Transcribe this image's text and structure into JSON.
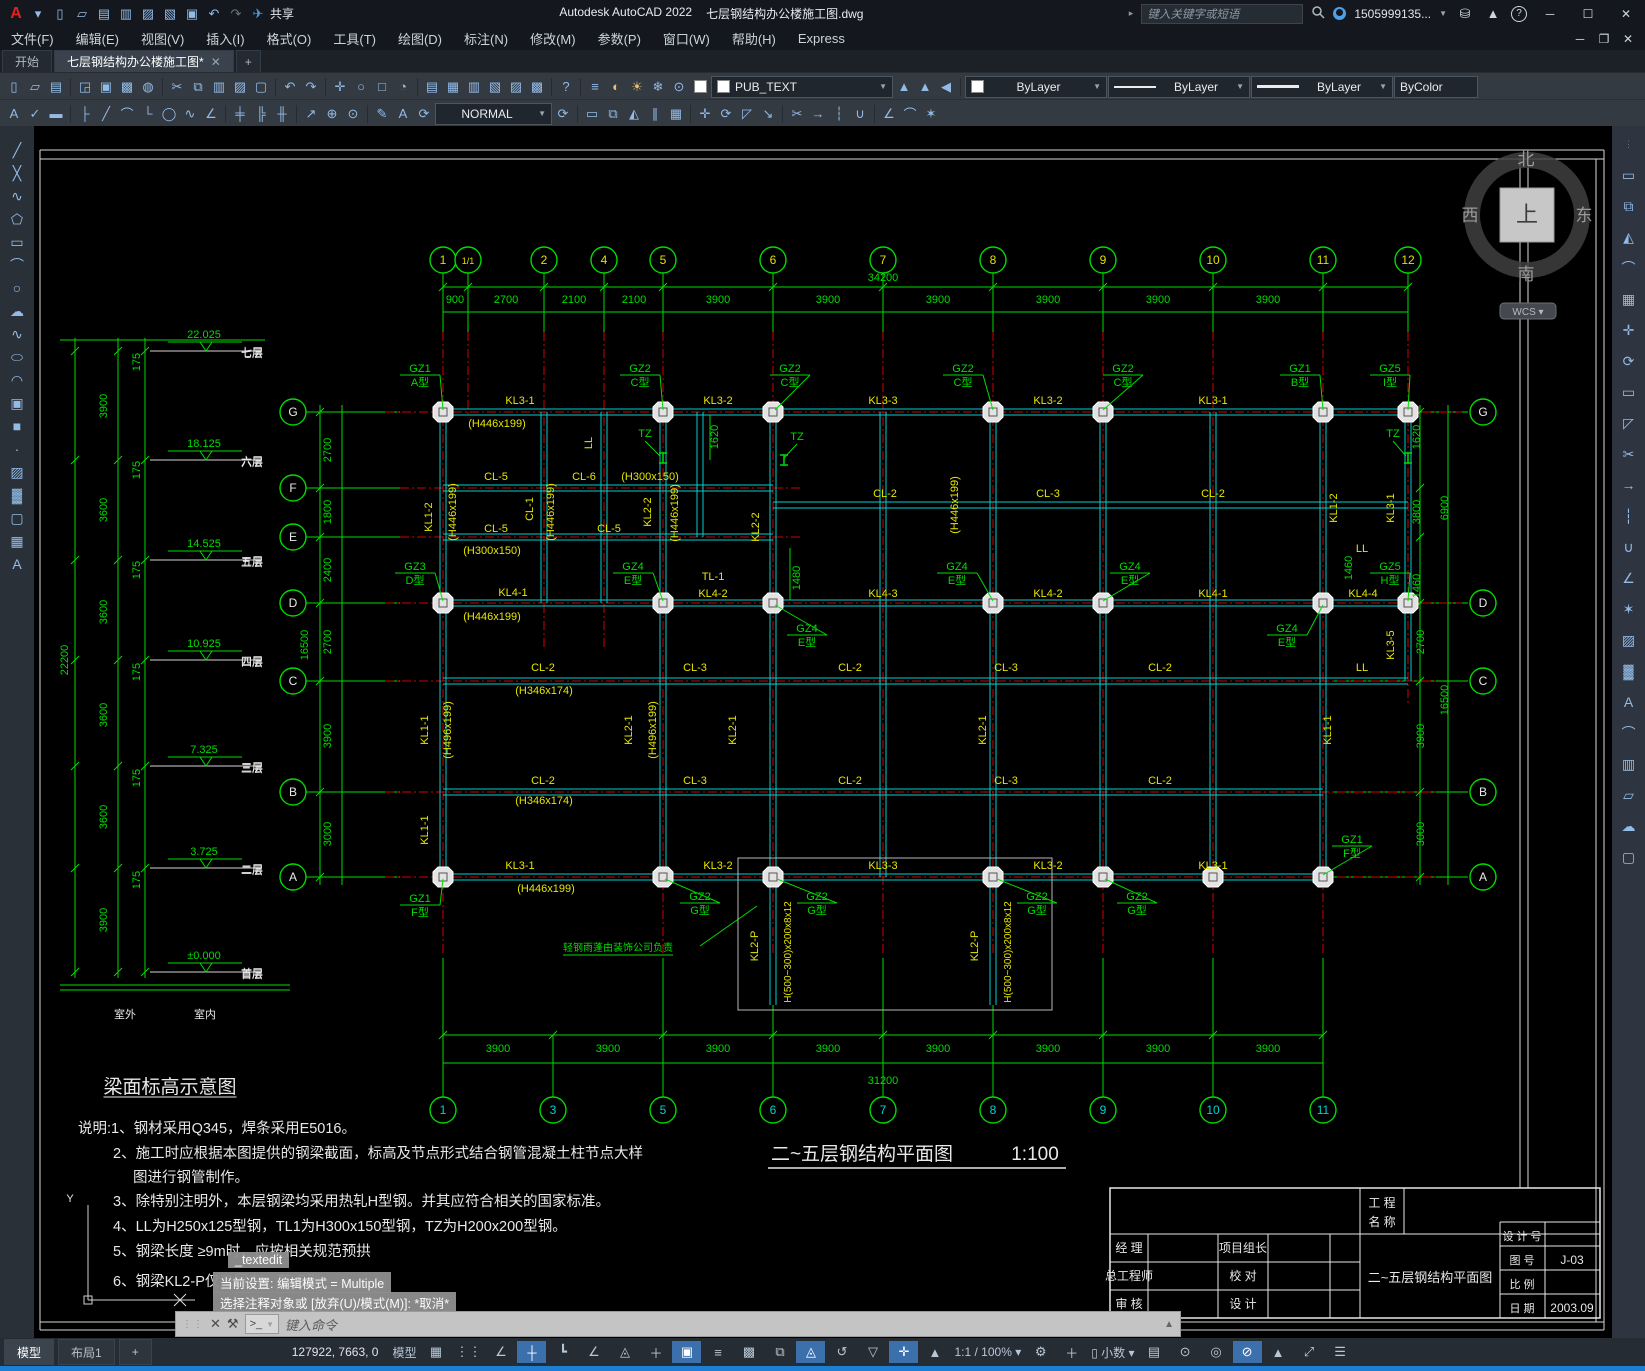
{
  "window": {
    "app_title": "Autodesk AutoCAD 2022",
    "doc_title": "七层钢结构办公楼施工图.dwg",
    "share_label": "共享",
    "search_placeholder": "键入关键字或短语",
    "username": "1505999135...",
    "win_min": "─",
    "win_max": "☐",
    "win_close": "✕",
    "doc_min": "─",
    "doc_restore": "❐",
    "doc_close": "✕"
  },
  "menus": [
    "文件(F)",
    "编辑(E)",
    "视图(V)",
    "插入(I)",
    "格式(O)",
    "工具(T)",
    "绘图(D)",
    "标注(N)",
    "修改(M)",
    "参数(P)",
    "窗口(W)",
    "帮助(H)",
    "Express"
  ],
  "tabs": {
    "start": "开始",
    "doc": "七层钢结构办公楼施工图*",
    "close": "✕",
    "plus": "+"
  },
  "qat_icons": [
    "app-logo",
    "caret-down",
    "new-file",
    "open-folder",
    "save",
    "save-as",
    "export",
    "sheet",
    "print",
    "undo",
    "redo",
    "share-plane"
  ],
  "toolbar1_icons": [
    "new-file",
    "open-folder",
    "save",
    "plot-preview",
    "plot",
    "page-setup",
    "publish-web",
    "cut",
    "copy",
    "paste",
    "match-properties",
    "block-editor",
    "undo",
    "redo",
    "pan",
    "zoom-realtime",
    "zoom-window",
    "zoom-previous",
    "properties",
    "design-center",
    "tool-palettes",
    "sheet-set",
    "markup",
    "quick-calc",
    "help"
  ],
  "layer_icons": [
    "layer-properties",
    "bulb",
    "sun",
    "freeze",
    "lock",
    "color-swatch"
  ],
  "layer_tool_icons": [
    "make-current",
    "match-layer",
    "layer-previous"
  ],
  "toolbar2_left_icons": [
    "text-edit",
    "spell-check",
    "edit-eraser"
  ],
  "dim_icons": [
    "dim-linear",
    "dim-aligned",
    "dim-arc",
    "dim-ordinate",
    "dim-radius",
    "dim-jogged",
    "dim-angular",
    "quick-dim",
    "dim-baseline",
    "dim-continue",
    "leader",
    "tolerance",
    "center-mark",
    "dim-edit",
    "dim-text-edit",
    "dim-update"
  ],
  "modify_icons": [
    "erase",
    "copy",
    "mirror",
    "offset",
    "array",
    "move",
    "rotate",
    "scale",
    "stretch",
    "trim",
    "extend",
    "break",
    "join",
    "chamfer",
    "fillet",
    "explode"
  ],
  "draw_icons_left": [
    "line",
    "xline",
    "polyline",
    "polygon",
    "rectangle",
    "arc",
    "circle",
    "revcloud",
    "spline",
    "ellipse",
    "ellipse-arc",
    "insert-block",
    "make-block",
    "point",
    "hatch",
    "gradient",
    "region",
    "table",
    "mtext"
  ],
  "right_icons": [
    "grip",
    "erase",
    "copy",
    "mirror",
    "fillet",
    "array",
    "move",
    "rotate",
    "rectangle",
    "scale",
    "trim",
    "extend",
    "break",
    "join",
    "chamfer",
    "explode",
    "hatch",
    "gradient",
    "text",
    "measure",
    "paste",
    "wipeout",
    "revcloud",
    "boundary"
  ],
  "combos": {
    "layer": "PUB_TEXT",
    "dimstyle": "NORMAL",
    "color": "ByLayer",
    "linetype": "ByLayer",
    "lineweight": "ByLayer",
    "plotstyle": "ByColor"
  },
  "viewcube": {
    "north": "北",
    "south": "南",
    "east": "东",
    "west": "西",
    "top": "上",
    "wcs": "WCS"
  },
  "statusbar": {
    "tabs": [
      "模型",
      "布局1",
      "+"
    ],
    "coords": "127922, 7663, 0",
    "model_btn": "模型",
    "scale": "1:1 / 100%",
    "units": "小数",
    "icons_a": [
      "grid",
      "snap",
      "infer",
      "dynamic-input",
      "ortho",
      "polar",
      "iso",
      "otrack",
      "osnap"
    ],
    "icons_b": [
      "lineweight",
      "transparency",
      "cycling",
      "3dosnap",
      "ducs",
      "filter",
      "gizmo",
      "annotation"
    ],
    "icons_c": [
      "quick-properties",
      "lock-ui",
      "isolate",
      "hardware",
      "performance",
      "clean-screen",
      "customize"
    ]
  },
  "overlays": {
    "textedit": "_textedit",
    "current_setting": "当前设置: 编辑模式 = Multiple",
    "prompt": "选择注释对象或 [放弃(U)/模式(M)]: *取消*",
    "cmd_placeholder": "键入命令"
  },
  "titleblock": {
    "project_l1": "工  程",
    "project_l2": "名  称",
    "manager": "经  理",
    "chief": "总工程师",
    "review": "审  核",
    "leader": "项目组长",
    "proof": "校  对",
    "design": "设  计",
    "drawing_name": "二~五层钢结构平面图",
    "design_no": "设 计 号",
    "sheet_no": "图  号",
    "sheet_no_value": "J-03",
    "scale_label": "比  例",
    "date_label": "日  期",
    "date_value": "2003.09"
  },
  "drawing": {
    "plan_title": "二~五层钢结构平面图",
    "plan_scale": "1:100",
    "top_bubbles": [
      [
        "1",
        443
      ],
      [
        "1/1",
        468
      ],
      [
        "2",
        544
      ],
      [
        "4",
        604
      ],
      [
        "5",
        663
      ],
      [
        "6",
        773
      ],
      [
        "7",
        883
      ],
      [
        "8",
        993
      ],
      [
        "9",
        1103
      ],
      [
        "10",
        1213
      ],
      [
        "11",
        1323
      ],
      [
        "12",
        1408
      ]
    ],
    "bottom_bubbles": [
      [
        "1",
        443
      ],
      [
        "3",
        553
      ],
      [
        "5",
        663
      ],
      [
        "6",
        773
      ],
      [
        "7",
        883
      ],
      [
        "8",
        993
      ],
      [
        "9",
        1103
      ],
      [
        "10",
        1213
      ],
      [
        "11",
        1323
      ]
    ],
    "row_bubbles_left": [
      [
        "G",
        412
      ],
      [
        "F",
        488
      ],
      [
        "E",
        537
      ],
      [
        "D",
        603
      ],
      [
        "C",
        681
      ],
      [
        "B",
        792
      ],
      [
        "A",
        877
      ]
    ],
    "row_bubbles_right": [
      [
        "G",
        412
      ],
      [
        "D",
        603
      ],
      [
        "C",
        681
      ],
      [
        "B",
        792
      ],
      [
        "A",
        877
      ]
    ],
    "levels": [
      [
        "22.025",
        "七层",
        351
      ],
      [
        "18.125",
        "六层",
        460
      ],
      [
        "14.525",
        "五层",
        560
      ],
      [
        "10.925",
        "四层",
        660
      ],
      [
        "7.325",
        "三层",
        766
      ],
      [
        "3.725",
        "二层",
        868
      ],
      [
        "±0.000",
        "首层",
        972
      ]
    ],
    "gz_tags": [
      [
        "GZ1",
        "A型",
        420,
        372,
        443,
        410
      ],
      [
        "GZ2",
        "C型",
        640,
        372,
        663,
        410
      ],
      [
        "GZ2",
        "C型",
        790,
        372,
        775,
        410
      ],
      [
        "GZ2",
        "C型",
        963,
        372,
        993,
        410
      ],
      [
        "GZ2",
        "C型",
        1123,
        372,
        1103,
        410
      ],
      [
        "GZ1",
        "B型",
        1300,
        372,
        1323,
        410
      ],
      [
        "GZ5",
        "I型",
        1390,
        372,
        1408,
        410
      ],
      [
        "GZ3",
        "D型",
        415,
        570,
        443,
        601
      ],
      [
        "GZ4",
        "E型",
        633,
        570,
        663,
        601
      ],
      [
        "GZ4",
        "E型",
        807,
        632,
        775,
        605
      ],
      [
        "GZ4",
        "E型",
        957,
        570,
        993,
        601
      ],
      [
        "GZ4",
        "E型",
        1130,
        570,
        1103,
        601
      ],
      [
        "GZ4",
        "E型",
        1287,
        632,
        1323,
        605
      ],
      [
        "GZ5",
        "H型",
        1390,
        570,
        1408,
        601
      ],
      [
        "GZ1",
        "F型",
        420,
        902,
        443,
        879
      ],
      [
        "GZ2",
        "G型",
        700,
        900,
        665,
        879
      ],
      [
        "GZ2",
        "G型",
        817,
        900,
        777,
        879
      ],
      [
        "GZ2",
        "G型",
        1037,
        900,
        997,
        879
      ],
      [
        "GZ2",
        "G型",
        1137,
        900,
        1105,
        879
      ],
      [
        "GZ1",
        "F型",
        1352,
        843,
        1323,
        875
      ]
    ],
    "texts": [
      [
        "KL3-1",
        520,
        404,
        "y"
      ],
      [
        "KL3-2",
        718,
        404,
        "y"
      ],
      [
        "KL3-3",
        883,
        404,
        "y"
      ],
      [
        "KL3-2",
        1048,
        404,
        "y"
      ],
      [
        "KL3-1",
        1213,
        404,
        "y"
      ],
      [
        "(H446x199)",
        497,
        427,
        "y"
      ],
      [
        "CL-5",
        496,
        480,
        "y"
      ],
      [
        "CL-6",
        584,
        480,
        "y"
      ],
      [
        "(H300x150)",
        650,
        480,
        "y"
      ],
      [
        "CL-5",
        496,
        532,
        "y"
      ],
      [
        "CL-5",
        609,
        532,
        "y"
      ],
      [
        "(H300x150)",
        492,
        554,
        "y"
      ],
      [
        "CL-1",
        533,
        509,
        "yr"
      ],
      [
        "(H446x199)",
        456,
        512,
        "yr"
      ],
      [
        "(H446x199)",
        554,
        512,
        "yr"
      ],
      [
        "KL1-2",
        432,
        517,
        "yr"
      ],
      [
        "KL2-2",
        651,
        512,
        "yr"
      ],
      [
        "(H446x199)",
        678,
        513,
        "yr"
      ],
      [
        "KL2-2",
        759,
        527,
        "yr"
      ],
      [
        "(H446x199)",
        958,
        505,
        "yr"
      ],
      [
        "LL",
        592,
        443,
        "yr"
      ],
      [
        "LL",
        1362,
        671,
        "y"
      ],
      [
        "LL",
        1362,
        552,
        "y"
      ],
      [
        "TZ",
        645,
        437,
        "g"
      ],
      [
        "TZ",
        797,
        440,
        "g"
      ],
      [
        "TZ",
        1393,
        437,
        "g"
      ],
      [
        "CL-2",
        885,
        497,
        "y"
      ],
      [
        "CL-3",
        1048,
        497,
        "y"
      ],
      [
        "CL-2",
        1213,
        497,
        "y"
      ],
      [
        "KL4-1",
        513,
        596,
        "y"
      ],
      [
        "TL-1",
        713,
        580,
        "y"
      ],
      [
        "KL4-2",
        713,
        597,
        "y"
      ],
      [
        "KL4-3",
        883,
        597,
        "y"
      ],
      [
        "KL4-2",
        1048,
        597,
        "y"
      ],
      [
        "KL4-1",
        1213,
        597,
        "y"
      ],
      [
        "KL4-4",
        1363,
        597,
        "y"
      ],
      [
        "(H446x199)",
        492,
        620,
        "y"
      ],
      [
        "CL-2",
        543,
        671,
        "y"
      ],
      [
        "CL-3",
        695,
        671,
        "y"
      ],
      [
        "CL-2",
        850,
        671,
        "y"
      ],
      [
        "CL-3",
        1006,
        671,
        "y"
      ],
      [
        "CL-2",
        1160,
        671,
        "y"
      ],
      [
        "(H346x174)",
        544,
        694,
        "y"
      ],
      [
        "KL1-1",
        428,
        730,
        "yr"
      ],
      [
        "(H496x199)",
        451,
        730,
        "yr"
      ],
      [
        "KL2-1",
        632,
        730,
        "yr"
      ],
      [
        "(H496x199)",
        656,
        730,
        "yr"
      ],
      [
        "KL2-1",
        736,
        730,
        "yr"
      ],
      [
        "KL2-1",
        986,
        730,
        "yr"
      ],
      [
        "KL1-1",
        1331,
        730,
        "yr"
      ],
      [
        "KL1-1",
        428,
        830,
        "yr"
      ],
      [
        "KL1-2",
        1337,
        508,
        "yr"
      ],
      [
        "KL3-1",
        1394,
        508,
        "yr"
      ],
      [
        "KL3-5",
        1394,
        645,
        "yr"
      ],
      [
        "CL-2",
        543,
        784,
        "y"
      ],
      [
        "CL-3",
        695,
        784,
        "y"
      ],
      [
        "CL-2",
        850,
        784,
        "y"
      ],
      [
        "CL-3",
        1006,
        784,
        "y"
      ],
      [
        "CL-2",
        1160,
        784,
        "y"
      ],
      [
        "(H346x174)",
        544,
        804,
        "y"
      ],
      [
        "KL3-1",
        520,
        869,
        "y"
      ],
      [
        "KL3-2",
        718,
        869,
        "y"
      ],
      [
        "KL3-3",
        883,
        869,
        "y"
      ],
      [
        "KL3-2",
        1048,
        869,
        "y"
      ],
      [
        "KL3-1",
        1213,
        869,
        "y"
      ],
      [
        "(H446x199)",
        546,
        892,
        "y"
      ],
      [
        "KL2-P",
        758,
        946,
        "yr"
      ],
      [
        "H(500~300)x200x8x12",
        791,
        952,
        "yrs"
      ],
      [
        "KL2-P",
        978,
        946,
        "yr"
      ],
      [
        "H(500~300)x200x8x12",
        1011,
        952,
        "yrs"
      ],
      [
        "轻钢雨蓬由装饰公司负责",
        618,
        951,
        "gsu"
      ],
      [
        "900",
        455,
        303,
        "g"
      ],
      [
        "2700",
        506,
        303,
        "g"
      ],
      [
        "2100",
        574,
        303,
        "g"
      ],
      [
        "2100",
        634,
        303,
        "g"
      ],
      [
        "3900",
        718,
        303,
        "g"
      ],
      [
        "3900",
        828,
        303,
        "g"
      ],
      [
        "3900",
        938,
        303,
        "g"
      ],
      [
        "3900",
        1048,
        303,
        "g"
      ],
      [
        "3900",
        1158,
        303,
        "g"
      ],
      [
        "3900",
        1268,
        303,
        "g"
      ],
      [
        "34200",
        883,
        281,
        "g"
      ],
      [
        "3900",
        498,
        1052,
        "g"
      ],
      [
        "3900",
        608,
        1052,
        "g"
      ],
      [
        "3900",
        718,
        1052,
        "g"
      ],
      [
        "3900",
        828,
        1052,
        "g"
      ],
      [
        "3900",
        938,
        1052,
        "g"
      ],
      [
        "3900",
        1048,
        1052,
        "g"
      ],
      [
        "3900",
        1158,
        1052,
        "g"
      ],
      [
        "3900",
        1268,
        1052,
        "g"
      ],
      [
        "31200",
        883,
        1084,
        "g"
      ],
      [
        "2700",
        331,
        450,
        "gr"
      ],
      [
        "1800",
        331,
        512,
        "gr"
      ],
      [
        "2400",
        331,
        570,
        "gr"
      ],
      [
        "2700",
        331,
        642,
        "gr"
      ],
      [
        "3900",
        331,
        736,
        "gr"
      ],
      [
        "3000",
        331,
        834,
        "gr"
      ],
      [
        "16500",
        308,
        645,
        "gr"
      ],
      [
        "1620",
        718,
        437,
        "gr"
      ],
      [
        "1480",
        800,
        578,
        "gr"
      ],
      [
        "1460",
        1352,
        568,
        "gr"
      ],
      [
        "1620",
        1420,
        437,
        "gr"
      ],
      [
        "3800",
        1420,
        512,
        "gr"
      ],
      [
        "1460",
        1420,
        586,
        "gr"
      ],
      [
        "6900",
        1448,
        508,
        "gr"
      ],
      [
        "2700",
        1424,
        642,
        "gr"
      ],
      [
        "16500",
        1448,
        700,
        "gr"
      ],
      [
        "3900",
        1424,
        736,
        "gr"
      ],
      [
        "3000",
        1424,
        834,
        "gr"
      ],
      [
        "3900",
        107,
        406,
        "gr"
      ],
      [
        "3600",
        107,
        510,
        "gr"
      ],
      [
        "3600",
        107,
        612,
        "gr"
      ],
      [
        "3600",
        107,
        715,
        "gr"
      ],
      [
        "3600",
        107,
        817,
        "gr"
      ],
      [
        "3900",
        107,
        920,
        "gr"
      ],
      [
        "22200",
        68,
        660,
        "gr"
      ],
      [
        "175",
        140,
        362,
        "gr"
      ],
      [
        "175",
        140,
        470,
        "gr"
      ],
      [
        "175",
        140,
        570,
        "gr"
      ],
      [
        "175",
        140,
        672,
        "gr"
      ],
      [
        "175",
        140,
        778,
        "gr"
      ],
      [
        "175",
        140,
        880,
        "gr"
      ],
      [
        "室外",
        125,
        1018,
        "w"
      ],
      [
        "室内",
        205,
        1018,
        "w"
      ],
      [
        "七层",
        252,
        357,
        "w"
      ],
      [
        "六层",
        252,
        466,
        "w"
      ],
      [
        "五层",
        252,
        566,
        "w"
      ],
      [
        "四层",
        252,
        666,
        "w"
      ],
      [
        "三层",
        252,
        772,
        "w"
      ],
      [
        "二层",
        252,
        874,
        "w"
      ],
      [
        "首层",
        252,
        978,
        "w"
      ],
      [
        "梁面标高示意图",
        170,
        1093,
        "wtu"
      ],
      [
        "说明:1、钢材采用Q345，焊条采用E5016。",
        78,
        1133,
        "wnl"
      ],
      [
        "2、施工时应根据本图提供的钢梁截面，标高及节点形式结合钢管混凝土柱节点大样",
        113,
        1158,
        "wnl"
      ],
      [
        "图进行钢管制作。",
        133,
        1182,
        "wnl"
      ],
      [
        "3、除特别注明外，本层钢梁均采用热轧H型钢。并其应符合相关的国家标准。",
        113,
        1206,
        "wnl"
      ],
      [
        "4、LL为H250x125型钢，TL1为H300x150型钢，TZ为H200x200型钢。",
        113,
        1231,
        "wnl"
      ],
      [
        "5、钢梁长度 ≥9m时，应按相关规范预拱",
        113,
        1256,
        "wnl"
      ],
      [
        "6、钢梁KL2-P仅二层有，节点型",
        113,
        1286,
        "wnl"
      ],
      [
        "二~五层钢结构平面图",
        862,
        1160,
        "wt"
      ],
      [
        "1:100",
        1035,
        1160,
        "wt"
      ],
      [
        "Y",
        70,
        1202,
        "w"
      ]
    ]
  }
}
